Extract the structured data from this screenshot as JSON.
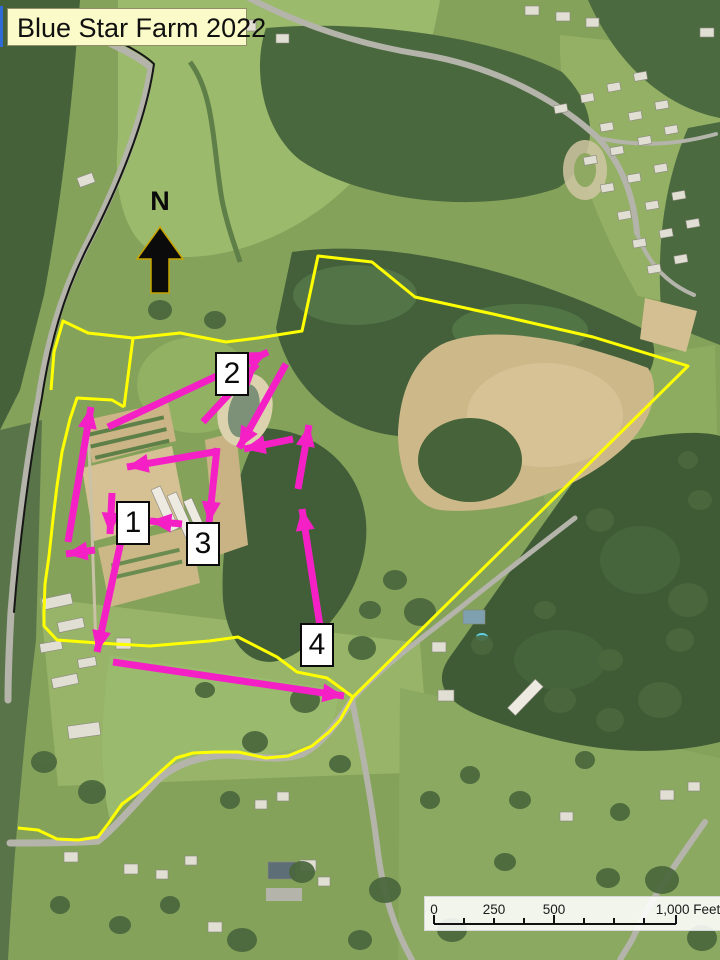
{
  "map": {
    "title": "Blue Star Farm 2022",
    "north_label": "N",
    "colors": {
      "boundary": "#FFFF00",
      "arrow": "#F520C5",
      "label_bg": "#FFFFFF",
      "label_border": "#0A0A0A",
      "title_bg": "#FBFBC9",
      "north_arrow_fill": "#0B0B0B",
      "north_arrow_outline": "#C8A400"
    },
    "labels": [
      {
        "text": "1",
        "cx": 133,
        "cy": 523
      },
      {
        "text": "2",
        "cx": 232,
        "cy": 374
      },
      {
        "text": "3",
        "cx": 203,
        "cy": 544
      },
      {
        "text": "4",
        "cx": 317,
        "cy": 645
      }
    ],
    "arrows": [
      {
        "x1": 68,
        "y1": 542,
        "x2": 91,
        "y2": 407
      },
      {
        "x1": 95,
        "y1": 550,
        "x2": 66,
        "y2": 554
      },
      {
        "x1": 112,
        "y1": 493,
        "x2": 110,
        "y2": 534
      },
      {
        "x1": 182,
        "y1": 524,
        "x2": 150,
        "y2": 521
      },
      {
        "x1": 214,
        "y1": 452,
        "x2": 127,
        "y2": 467
      },
      {
        "x1": 217,
        "y1": 448,
        "x2": 209,
        "y2": 523
      },
      {
        "x1": 108,
        "y1": 427,
        "x2": 268,
        "y2": 352
      },
      {
        "x1": 203,
        "y1": 422,
        "x2": 257,
        "y2": 364
      },
      {
        "x1": 286,
        "y1": 364,
        "x2": 239,
        "y2": 448
      },
      {
        "x1": 293,
        "y1": 439,
        "x2": 244,
        "y2": 449
      },
      {
        "x1": 121,
        "y1": 541,
        "x2": 97,
        "y2": 652
      },
      {
        "x1": 113,
        "y1": 662,
        "x2": 344,
        "y2": 696
      },
      {
        "x1": 320,
        "y1": 626,
        "x2": 302,
        "y2": 509
      },
      {
        "x1": 298,
        "y1": 489,
        "x2": 309,
        "y2": 425
      }
    ],
    "boundary_paths": [
      {
        "points": "124,407 133,338 180,333 226,342 258,338 302,331 318,256 372,262 415,297 493,314 593,337 688,366 353,697 327,678 297,672 277,657 238,637 209,641 150,646 98,643 57,640 44,626 44,611 45,584 49,556 53,519 57,486 62,452 70,419 77,398 112,400 124,407"
      },
      {
        "points": "133,338 88,333 63,321 54,352 51,390"
      },
      {
        "points": "353,697 340,720 329,732 312,746 288,756 266,758 238,752 216,752 193,753 176,758 158,774 140,791 122,804 108,824 98,837 78,840 57,839 38,830 18,828"
      }
    ],
    "scalebar": {
      "x": 424,
      "y": 896,
      "w": 296,
      "h": 33,
      "labels": [
        {
          "text": "0",
          "cx": 9
        },
        {
          "text": "250",
          "cx": 69
        },
        {
          "text": "500",
          "cx": 129
        },
        {
          "text": "1,000 Feet",
          "cx": 263
        }
      ],
      "ticks": [
        {
          "x": 9,
          "tall": true
        },
        {
          "x": 39,
          "tall": false
        },
        {
          "x": 69,
          "tall": false
        },
        {
          "x": 99,
          "tall": false
        },
        {
          "x": 129,
          "tall": true
        },
        {
          "x": 159,
          "tall": false
        },
        {
          "x": 189,
          "tall": false
        },
        {
          "x": 219,
          "tall": false
        },
        {
          "x": 251,
          "tall": true
        }
      ],
      "baseline_y": 27,
      "tall_h": 9,
      "minor_h": 6
    }
  }
}
